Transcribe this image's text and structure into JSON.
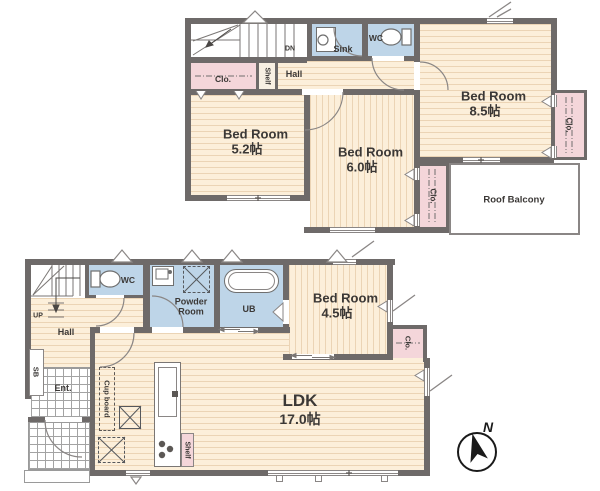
{
  "colors": {
    "wall": "#6e6a69",
    "floor": "#fcefda",
    "closet": "#f4d6da",
    "wet_area": "#bed5e8",
    "balcony_outline": "#8a8685",
    "label": "#3b3836"
  },
  "f2": {
    "stairs_label": "DN",
    "closet_left": "Clo.",
    "shelf": "Shelf",
    "hall": "Hall",
    "sink": "Sink",
    "wc": "WC",
    "bed85": {
      "name": "Bed Room",
      "size": "8.5帖"
    },
    "closet_right": "Clo.",
    "bed52": {
      "name": "Bed Room",
      "size": "5.2帖"
    },
    "bed60": {
      "name": "Bed Room",
      "size": "6.0帖"
    },
    "closet_mid": "Clo.",
    "balcony": "Roof Balcony"
  },
  "f1": {
    "stairs_label": "UP",
    "wc": "WC",
    "powder_room": "Powder Room",
    "bath": "UB",
    "bed45": {
      "name": "Bed Room",
      "size": "4.5帖"
    },
    "closet": "Clo.",
    "hall": "Hall",
    "shoe_box": "SB",
    "entrance": "Ent.",
    "cupboard": "Cup board",
    "shelf": "Shelf",
    "ldk": {
      "name": "LDK",
      "size": "17.0帖"
    }
  },
  "compass": {
    "north": "N"
  }
}
